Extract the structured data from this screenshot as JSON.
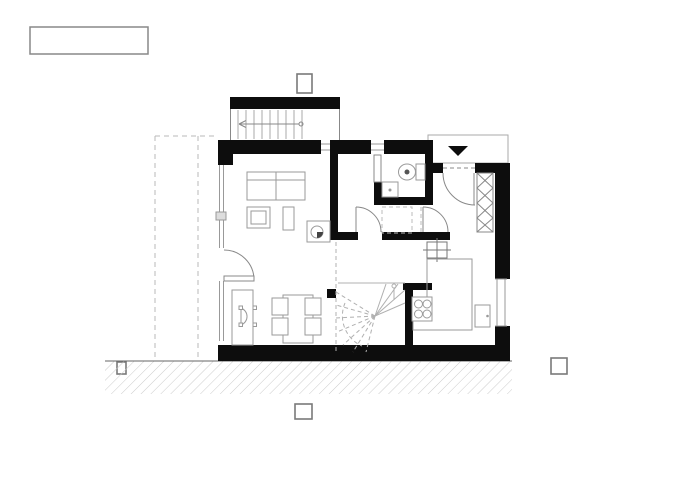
{
  "drawing": {
    "kind": "architectural-floor-plan-ground-floor",
    "title_block_text": "",
    "background": "#ffffff",
    "colors": {
      "wall_fill": "#0d0d0d",
      "furniture_outline": "#999999",
      "thin_line": "#888888",
      "dashed_line": "#b8b8b8",
      "ground_hatch": "#cccccc",
      "marker_border": "#7a7a7a"
    },
    "title_block": {
      "text": ""
    },
    "markers": {
      "style": "small empty squares with gray border",
      "positions": [
        "top-above-porch",
        "left-on-ground-line",
        "right-of-building",
        "bottom-below-ground"
      ]
    },
    "symbols": [
      "sofa",
      "armchair",
      "coffee-table",
      "wood-stove",
      "sideboard",
      "desk-chair",
      "dining-table",
      "dining-chair",
      "toilet",
      "washbasin",
      "kitchen-hob",
      "kitchen-counter",
      "refrigerator",
      "crosshair-point",
      "winder-staircase",
      "entry-steps",
      "step-direction-arrow",
      "entrance-triangle",
      "wardrobe-zigzag",
      "structural-column",
      "window-glazing",
      "door-swing-arc",
      "roof-overhang-dashed",
      "ground-hatch"
    ]
  }
}
